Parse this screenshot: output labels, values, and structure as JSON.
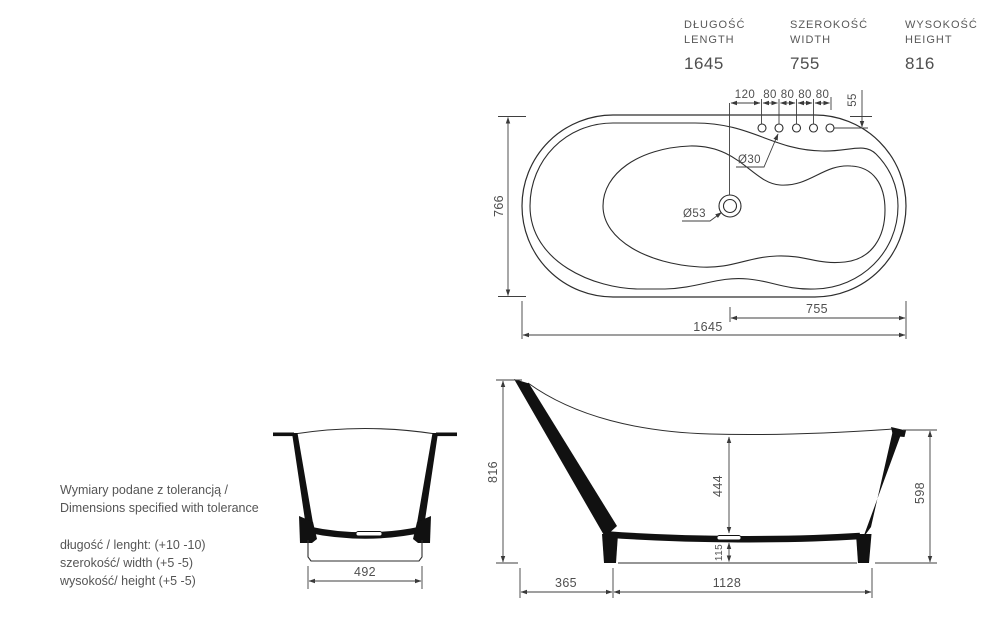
{
  "header": {
    "columns": [
      {
        "pl": "DŁUGOŚĆ",
        "en": "LENGTH",
        "value": "1645"
      },
      {
        "pl": "SZEROKOŚĆ",
        "en": "WIDTH",
        "value": "755"
      },
      {
        "pl": "WYSOKOŚĆ",
        "en": "HEIGHT",
        "value": "816"
      }
    ]
  },
  "top_view": {
    "overall_width": "766",
    "offsets": [
      "120",
      "80",
      "80",
      "80",
      "80"
    ],
    "edge_offset": "55",
    "faucet_hole_dia": "Ø30",
    "drain_dia": "Ø53",
    "overall_length": "1645",
    "deck_length": "755"
  },
  "front_view": {
    "base_width": "492"
  },
  "side_view": {
    "overall_height": "816",
    "inner_depth": "444",
    "base_height": "115",
    "front_height": "598",
    "back_overhang": "365",
    "base_length": "1128"
  },
  "notes": {
    "title_pl": "Wymiary podane z tolerancją /",
    "title_en": "Dimensions specified with tolerance",
    "length_tol": "długość / lenght: (+10 -10)",
    "width_tol": "szerokość/ width (+5 -5)",
    "height_tol": "wysokość/ height (+5 -5)"
  },
  "colors": {
    "line": "#2d2d2d",
    "dim_line": "#3f3f3f",
    "text": "#575757",
    "background": "#ffffff"
  }
}
